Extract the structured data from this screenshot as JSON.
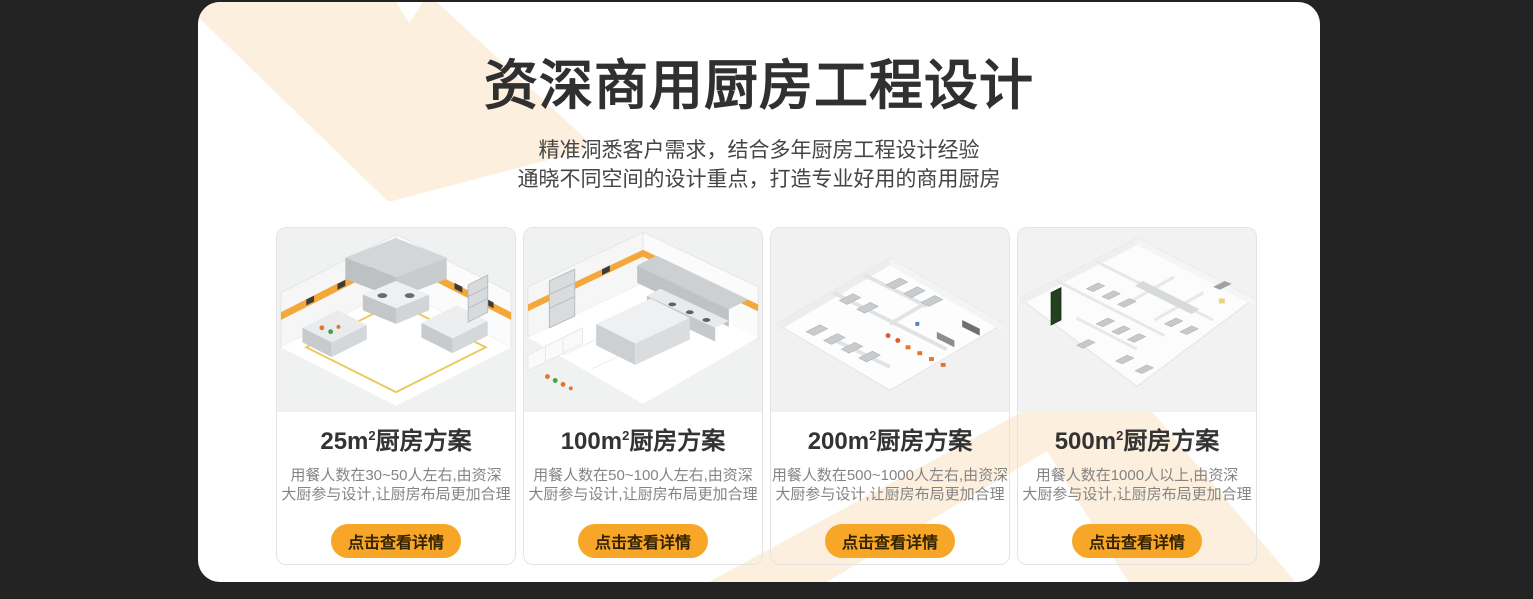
{
  "theme": {
    "page_background": "#232323",
    "panel_background": "#ffffff",
    "decor_chevron_color": "#fcefdd",
    "button_background": "#f7a628",
    "button_text_color": "#332200",
    "title_color": "#303030",
    "subtitle_color": "#454545",
    "card_title_color": "#333333",
    "card_description_color": "#848484",
    "caution_stripe_color": "#f2a83a"
  },
  "header": {
    "title": "资深商用厨房工程设计",
    "subtitle_lines": [
      "精准洞悉客户需求，结合多年厨房工程设计经验",
      "通晓不同空间的设计重点，打造专业好用的商用厨房"
    ]
  },
  "cards": [
    {
      "title_prefix": "25m",
      "title_sup": "2",
      "title_suffix": "厨房方案",
      "desc_line1": "用餐人数在30~50人左右,由资深",
      "desc_line2": "大厨参与设计,让厨房布局更加合理",
      "button_label": "点击查看详情"
    },
    {
      "title_prefix": "100m",
      "title_sup": "2",
      "title_suffix": "厨房方案",
      "desc_line1": "用餐人数在50~100人左右,由资深",
      "desc_line2": "大厨参与设计,让厨房布局更加合理",
      "button_label": "点击查看详情"
    },
    {
      "title_prefix": "200m",
      "title_sup": "2",
      "title_suffix": "厨房方案",
      "desc_line1": "用餐人数在500~1000人左右,由资深",
      "desc_line2": "大厨参与设计,让厨房布局更加合理",
      "button_label": "点击查看详情"
    },
    {
      "title_prefix": "500m",
      "title_sup": "2",
      "title_suffix": "厨房方案",
      "desc_line1": "用餐人数在1000人以上,由资深",
      "desc_line2": "大厨参与设计,让厨房布局更加合理",
      "button_label": "点击查看详情"
    }
  ]
}
